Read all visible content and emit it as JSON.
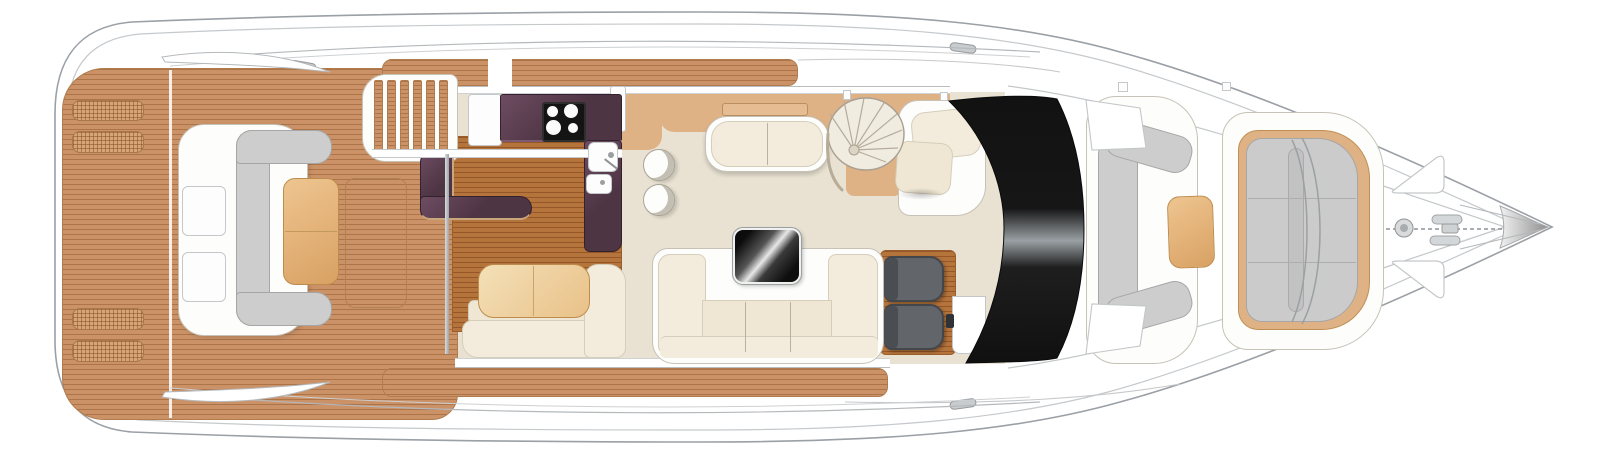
{
  "meta": {
    "title": "Motor yacht main deck floor plan (top view)"
  },
  "palette": {
    "hull-line": "#9aa0a6",
    "hull-inner": "#c5c9cc",
    "line-gray": "#b7bbbe",
    "teak-base": "#cb9268",
    "teak-line": "rgba(148,92,46,0.55)",
    "teak-edge": "#b07c4e",
    "teak-dark": "#b5743c",
    "teak-dark-line": "rgba(118,58,20,0.5)",
    "tan-wood": "#dfb286",
    "tan-table-light": "#eec590",
    "tan-table-dark": "#d9a163",
    "tan-table-edge": "#bd8c4c",
    "tan-accent": "#c8a77c",
    "carpet": "#e9e2d3",
    "cream": "#f3ecdc",
    "cream-deep": "#efe7d4",
    "cream-edge": "#d5cebb",
    "shell": "#fdfdfb",
    "shell-edge": "#c6c2b6",
    "gray-cushion": "#cdcdcd",
    "gray-cushion-edge": "#a6a6a6",
    "aubergine": "#4e3544",
    "aubergine-hi": "#6e4c62",
    "aubergine-edge": "#33222e",
    "cooktop-black": "#141414",
    "seat-gray": "#62666b",
    "seat-gray-dark": "#43474c",
    "steel": "#cfd2d4",
    "glazing-dark": "#111111",
    "glazing-light": "#9aa0a4"
  },
  "regions": [
    {
      "name": "swim-platform",
      "label": "Teak swim platform with deck hatches"
    },
    {
      "name": "transom-lounge",
      "label": "Transom C-shaped lounge seat with table"
    },
    {
      "name": "cockpit",
      "label": "Teak cockpit deck"
    },
    {
      "name": "flybridge-stairs",
      "label": "Steps to flybridge"
    },
    {
      "name": "galley",
      "label": "Aft galley with cooktop and twin sinks"
    },
    {
      "name": "dinette",
      "label": "Dinette with L-bench and table"
    },
    {
      "name": "saloon",
      "label": "Saloon with sofas and TV cabinet"
    },
    {
      "name": "spiral-staircase",
      "label": "Spiral staircase to lower deck"
    },
    {
      "name": "companion-seat",
      "label": "Companion seat"
    },
    {
      "name": "helm",
      "label": "Twin helm seats on teak platform"
    },
    {
      "name": "windscreen",
      "label": "Curved windscreen glazing"
    },
    {
      "name": "foredeck-lounge",
      "label": "Foredeck C-lounge with table"
    },
    {
      "name": "bow-sunpad",
      "label": "Bow sunpad"
    },
    {
      "name": "ground-tackle",
      "label": "Anchor windlass and chain"
    }
  ]
}
